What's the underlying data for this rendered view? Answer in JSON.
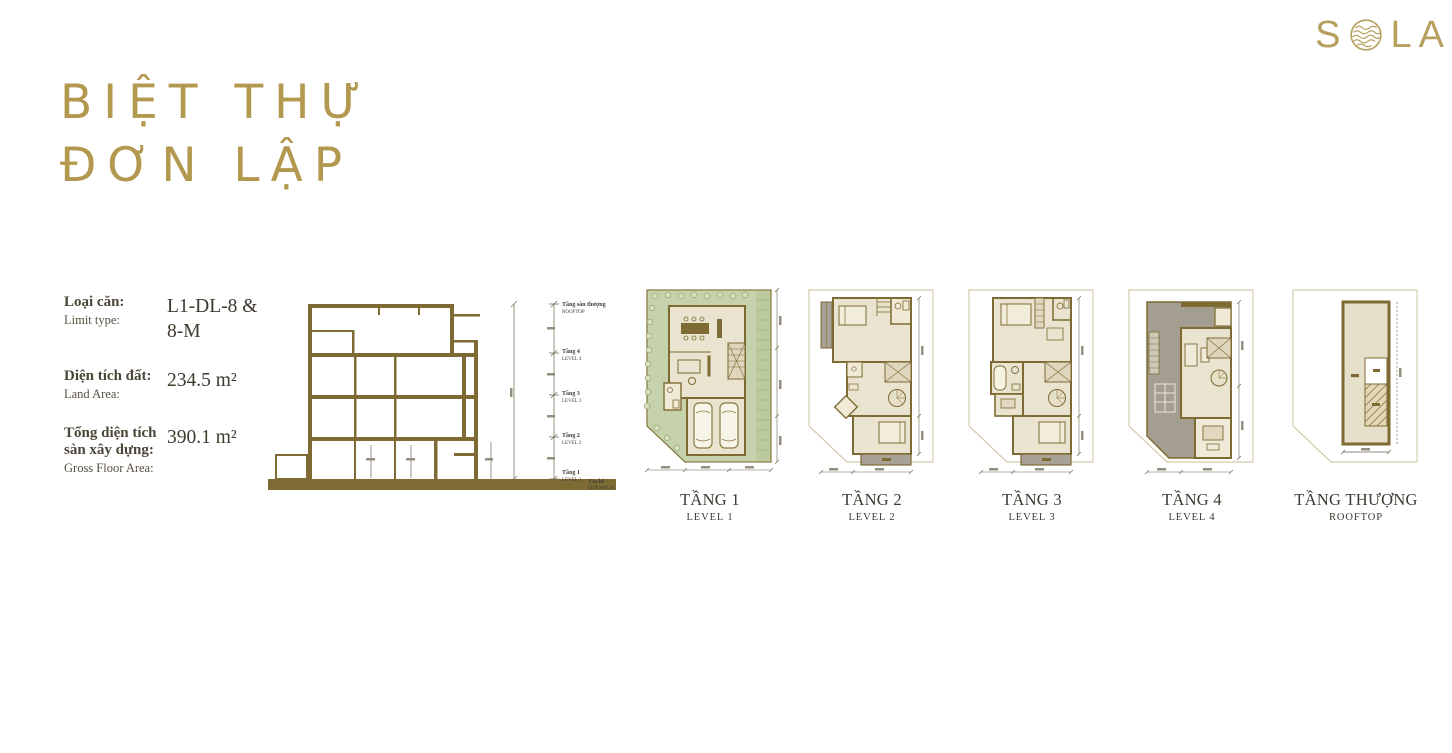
{
  "colors": {
    "gold": "#b3994f",
    "logo_gold": "#b5a05e",
    "olive_wall": "#7d6b33",
    "olive_outline": "#8b7b45",
    "site_green": "#c6d2ab",
    "planting_green": "#bccb9e",
    "floor_beige": "#e9e3cf",
    "balcony_gray": "#a8a196",
    "label_dark": "#3c3b32",
    "text_dark": "#4b4638"
  },
  "logo": {
    "text": "SOLA",
    "letters": [
      "S",
      "O",
      "L",
      "A"
    ]
  },
  "title": {
    "line1": "BIỆT THỰ",
    "line2": "ĐƠN LẬP"
  },
  "info": {
    "rows": [
      {
        "label_vi": "Loại căn:",
        "label_en": "Limit type:",
        "value": "L1-DL-8 & 8-M"
      },
      {
        "label_vi": "Diện tích đất:",
        "label_en": "Land Area:",
        "value": "234.5 m²"
      },
      {
        "label_vi": "Tổng diện tích sàn xây dựng:",
        "label_en": "Gross Floor Area:",
        "value": "390.1 m²"
      }
    ]
  },
  "section": {
    "levels": [
      {
        "vi": "Tầng sân thượng",
        "en": "ROOFTOP"
      },
      {
        "vi": "Tầng 4",
        "en": "LEVEL 4"
      },
      {
        "vi": "Tầng 3",
        "en": "LEVEL 3"
      },
      {
        "vi": "Tầng 2",
        "en": "LEVEL 2"
      },
      {
        "vi": "Tầng 1",
        "en": "LEVEL 1"
      }
    ],
    "sidewalk": {
      "vi": "Vỉa hè",
      "en": "SIDEWALK"
    }
  },
  "plans": [
    {
      "name": "TẦNG 1",
      "sub": "LEVEL 1"
    },
    {
      "name": "TẦNG 2",
      "sub": "LEVEL 2"
    },
    {
      "name": "TẦNG 3",
      "sub": "LEVEL 3"
    },
    {
      "name": "TẦNG 4",
      "sub": "LEVEL 4"
    },
    {
      "name": "TẦNG THƯỢNG",
      "sub": "ROOFTOP"
    }
  ]
}
